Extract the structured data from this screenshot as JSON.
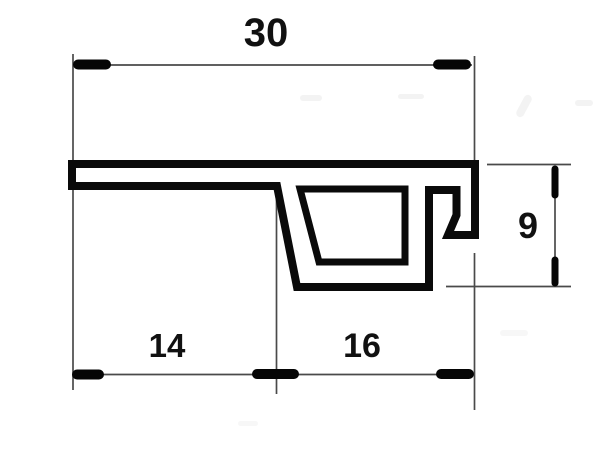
{
  "drawing": {
    "type": "technical-profile-cross-section",
    "dimensions": {
      "overall_width": "30",
      "left_span": "14",
      "right_span": "16",
      "height": "9"
    },
    "colors": {
      "background": "#ffffff",
      "profile_line": "#0a0a0a",
      "dimension_line": "#4a4a4a",
      "tick": "#050505",
      "text": "#111111"
    }
  }
}
